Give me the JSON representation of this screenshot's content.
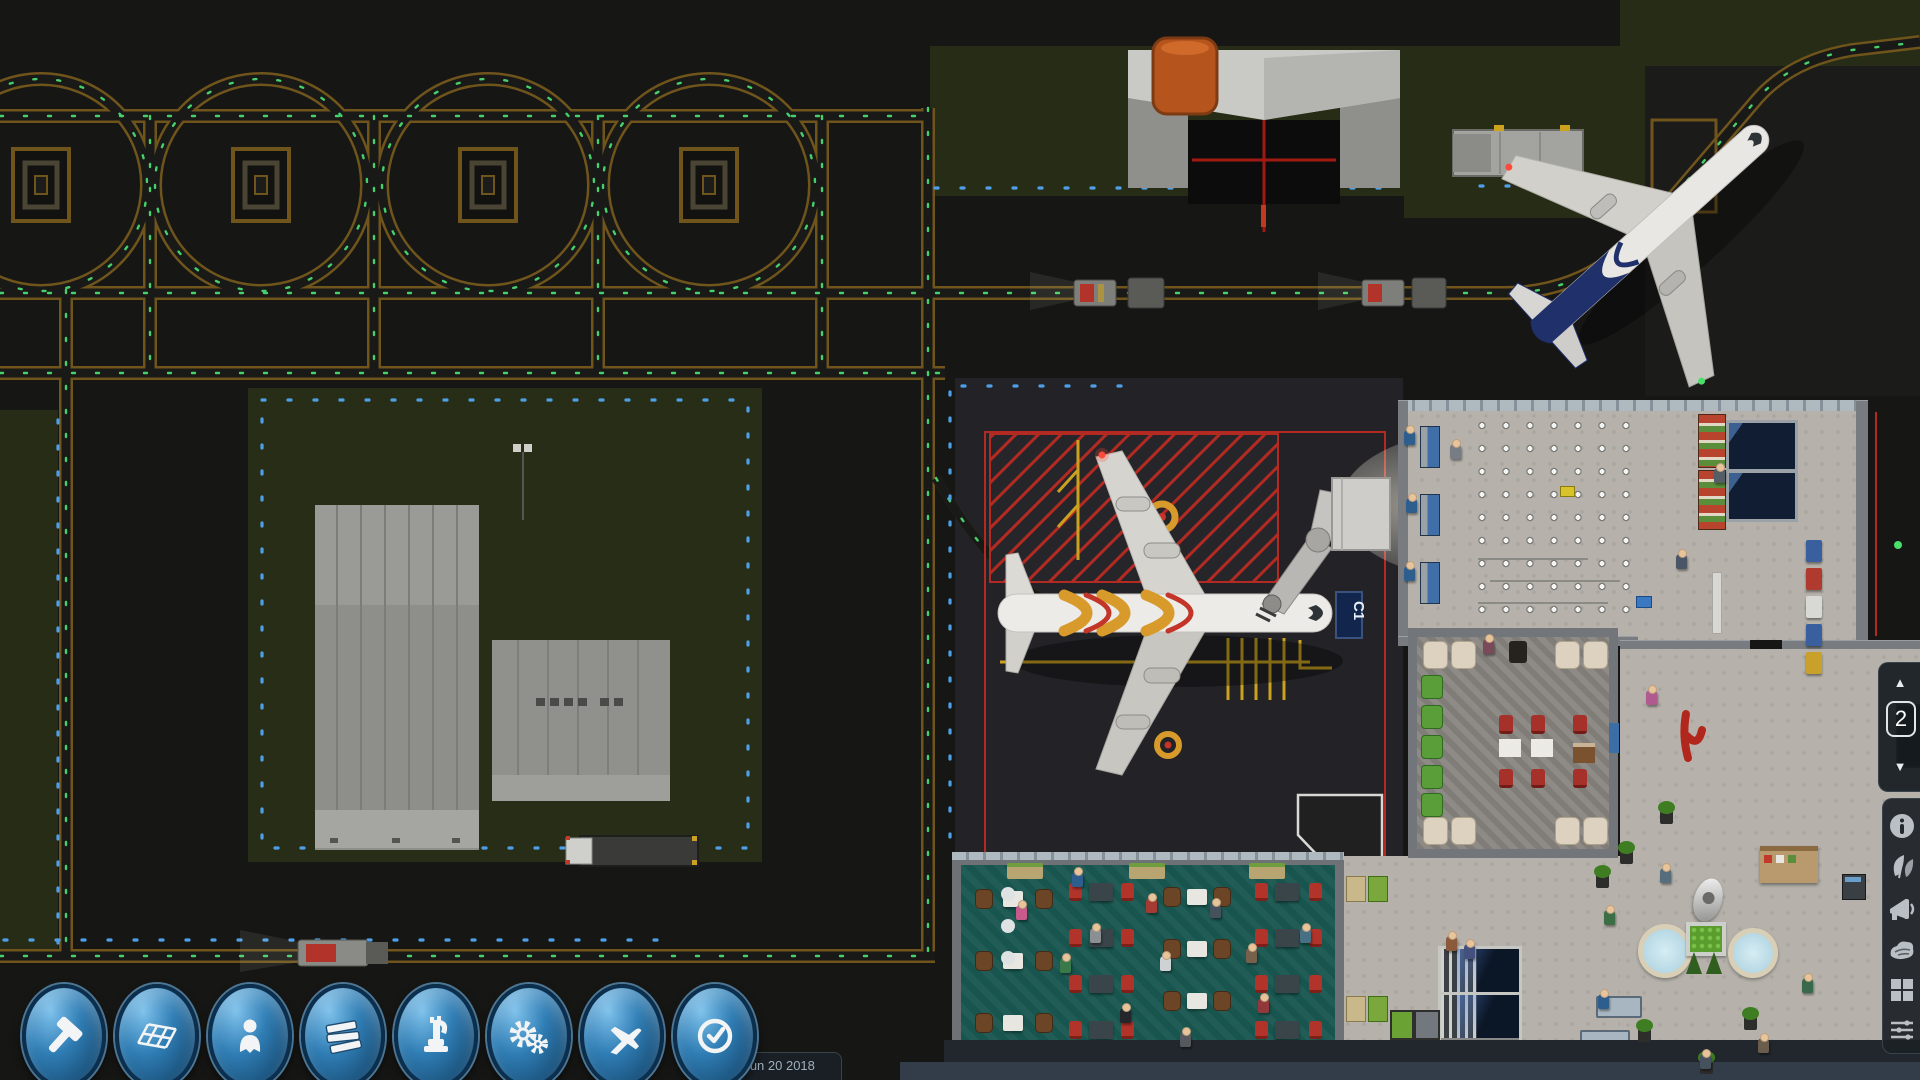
{
  "hud": {
    "help_label": "Help",
    "menu_label": "Menu",
    "currency_symbol": "S",
    "money": "$746,367",
    "satisfaction_pct": "75 %",
    "satisfaction_trend": "−",
    "flights_pct": "54 %",
    "wind": "21 Kt NE",
    "day_label": "Day 103",
    "clock_time": "7:49",
    "clock_meridiem": "PM",
    "sim_status": "Paused",
    "version_channel": "edge",
    "version_date": "Jun 20 2018",
    "gate_label": "C1"
  },
  "side_panel": {
    "floor_selector": {
      "up": "▲",
      "level": "2",
      "down": "▼"
    },
    "icons": [
      "info-icon",
      "foliage-icon",
      "megaphone-icon",
      "terrain-icon",
      "zones-grid-icon",
      "filters-icon"
    ]
  },
  "toolbar": {
    "buttons": [
      {
        "name": "build",
        "icon": "hammer-icon"
      },
      {
        "name": "flooring",
        "icon": "floor-grid-icon"
      },
      {
        "name": "staff",
        "icon": "person-icon"
      },
      {
        "name": "materials",
        "icon": "stack-icon"
      },
      {
        "name": "equipment",
        "icon": "machine-icon"
      },
      {
        "name": "operations",
        "icon": "gears-icon"
      },
      {
        "name": "flights",
        "icon": "airplane-icon"
      },
      {
        "name": "schedule",
        "icon": "clock-icon"
      }
    ]
  },
  "speed_controls": {
    "pause": "pause-icon",
    "play": "play-icon",
    "fast": "fast-forward-icon",
    "fastest": "fastest-forward-icon"
  },
  "colors": {
    "taxiway_line": "#6f541c",
    "centerline_green": "#46d06c",
    "edge_light_blue": "#4f9fe8",
    "money_gold": "#e8a73a",
    "alert_red": "#b32a22",
    "accent_blue": "#3f8fc0",
    "terminal_floor": "#b6b2ab",
    "food_court_teal": "#17554e",
    "grass_dark": "#262c15"
  }
}
